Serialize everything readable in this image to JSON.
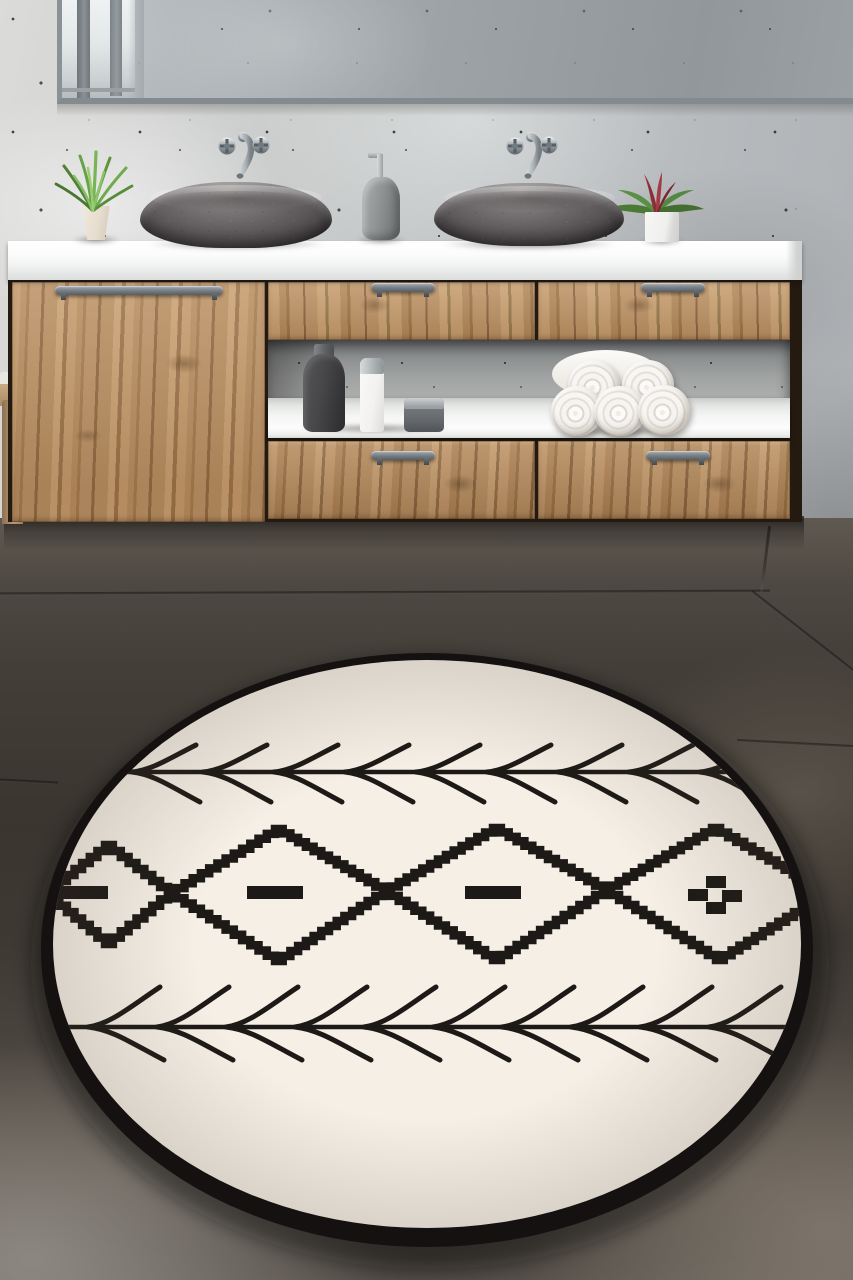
{
  "scene": {
    "description": "Product photo of a round cream rug with black Berber kilim motifs lying on a dark slate tile floor in a modern bathroom with an oak floating vanity, two grey stone vessel sinks and a wide mirror on a speckled concrete wall",
    "width": 853,
    "height": 1280,
    "no_visible_text": true
  },
  "labels": {
    "wall": "Speckled concrete wall",
    "mirror": "Wide wall mirror reflecting a window",
    "floor": "Dark slate tile floor",
    "counter": "White vanity countertop",
    "vanity": "Oak floating vanity cabinet",
    "left_door": "Tall oak cabinet door",
    "drawer": "Oak drawer with grey bar handle",
    "niche": "Open shelf niche",
    "shelf": "White open shelf",
    "sink_left": "Left grey stone vessel sink",
    "sink_right": "Right grey stone vessel sink",
    "faucet": "Wall-mounted chrome faucet with cross handles",
    "plant_green": "Green grass plant in cream pot",
    "plant_red": "Red bromeliad in white cube pot",
    "dispenser": "Grey soap dispenser with chrome pump",
    "bottle_dark": "Dark grey lotion bottle",
    "tube_white": "White bottle with chrome cap",
    "jar": "Grey jar with chrome lid",
    "towels": "Pyramid of five rolled white towels",
    "chair": "Edge of wooden chair",
    "rug": "Round cream rug with black fishbone lines and stepped diamond chain pattern"
  },
  "palette": {
    "wall": "#c1c5c6",
    "mirror_glass": "#9aa0a4",
    "mirror_frame": "#878e93",
    "wood": "#b68d60",
    "counter": "#f7f8f7",
    "sink_stone": "#5b585a",
    "floor_dark": "#3a352f",
    "floor_blur": "#716a62",
    "rug_cream": "#f5efe6",
    "rug_ink": "#1c1916",
    "chrome": "#aeb6ba",
    "handle": "#7d858b",
    "plant_green": "#67a148",
    "plant_red": "#8c2e39",
    "towel": "#f6f4f1"
  },
  "counts": {
    "sinks": 2,
    "faucets": 2,
    "towel_rolls": 5,
    "toiletry_items": 3,
    "drawers": 4,
    "doors": 1,
    "handles": 5,
    "plants": 2,
    "floor_seams": 5,
    "mirror_window_bars": 2
  },
  "rug": {
    "cream": "#f5efe6",
    "ink": "#1c1916",
    "border_color": "#141110",
    "outer": {
      "cx": 427,
      "cy": 950,
      "rx": 386,
      "ry": 297
    },
    "inner": {
      "cx": 427,
      "cy": 944,
      "rx": 374,
      "ry": 284
    },
    "shadow": {
      "cx": 430,
      "cy": 963,
      "rx": 399,
      "ry": 306,
      "opacity": 0.45,
      "blur": 9
    },
    "line_width": 4.5,
    "branch_width": 5,
    "band": {
      "stroke": 8.5,
      "step": 8,
      "upper": [
        [
          44,
          893
        ],
        [
          105,
          845
        ],
        [
          168,
          893
        ],
        [
          275,
          829
        ],
        [
          383,
          891
        ],
        [
          493,
          828
        ],
        [
          603,
          890
        ],
        [
          712,
          828
        ],
        [
          825,
          893
        ]
      ],
      "lower": [
        [
          44,
          893
        ],
        [
          105,
          944
        ],
        [
          168,
          893
        ],
        [
          275,
          961
        ],
        [
          383,
          891
        ],
        [
          493,
          960
        ],
        [
          603,
          890
        ],
        [
          716,
          960
        ],
        [
          825,
          893
        ]
      ]
    },
    "fishbones": [
      {
        "position": "top",
        "y": 772,
        "x0": 100,
        "x1": 792,
        "start": 132,
        "spacing": 71,
        "count": 9,
        "up": [
          64,
          -27
        ],
        "down": [
          68,
          30
        ]
      },
      {
        "position": "bottom",
        "y": 1027,
        "x0": 58,
        "x1": 800,
        "start": 88,
        "spacing": 69,
        "count": 10,
        "up": [
          72,
          -40
        ],
        "down": [
          76,
          33
        ]
      }
    ],
    "dashes": [
      [
        50,
        886,
        58,
        13
      ],
      [
        247,
        886,
        56,
        13
      ],
      [
        465,
        886,
        56,
        13
      ]
    ],
    "plus_squares": [
      [
        706,
        876,
        20,
        12
      ],
      [
        688,
        889,
        20,
        12
      ],
      [
        722,
        890,
        20,
        12
      ],
      [
        706,
        902,
        20,
        12
      ]
    ],
    "motifs": {
      "diamonds": 4,
      "dash_diamonds": 3,
      "checker_diamond": 1,
      "names": [
        "fishbone arrow line",
        "stepped diamond chain",
        "dash bar",
        "checker cross"
      ]
    }
  }
}
